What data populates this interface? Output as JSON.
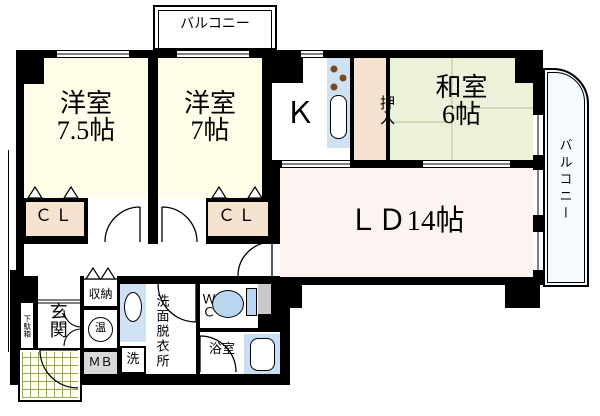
{
  "rooms": {
    "western1": {
      "name": "洋室",
      "size": "7.5帖"
    },
    "western2": {
      "name": "洋室",
      "size": "7帖"
    },
    "japanese": {
      "name": "和室",
      "size": "6帖"
    },
    "living_dining": {
      "label": "ＬＤ14帖"
    },
    "kitchen": {
      "label": "Ｋ"
    }
  },
  "storage": {
    "closet1": "ＣＬ",
    "closet2": "ＣＬ",
    "oshiire": "押入",
    "shuno": "収納",
    "getabako": "下駄箱"
  },
  "utility": {
    "genkan": "玄関",
    "water_heater": "温",
    "meter_box": "ＭＢ",
    "laundry": "洗",
    "washroom": "洗面脱衣所",
    "wc": "ＷＣ",
    "bath": "浴室"
  },
  "balconies": {
    "top": "バルコニー",
    "right": "バルコニー"
  },
  "colors": {
    "wall": "#000000",
    "western_room": "#fffce8",
    "japanese_room": "#ecf2da",
    "closet_peach": "#f6e2d0",
    "living_dining": "#fdf4f2",
    "fixture_blue": "#cfe2f3",
    "fixture_blue2": "#b9d5ef",
    "meter_box_gray": "#d9d9d9",
    "shaft_gray": "#c9c9c9",
    "porch_grid": "#99a55e",
    "balcony_bg": "#f5faff"
  }
}
